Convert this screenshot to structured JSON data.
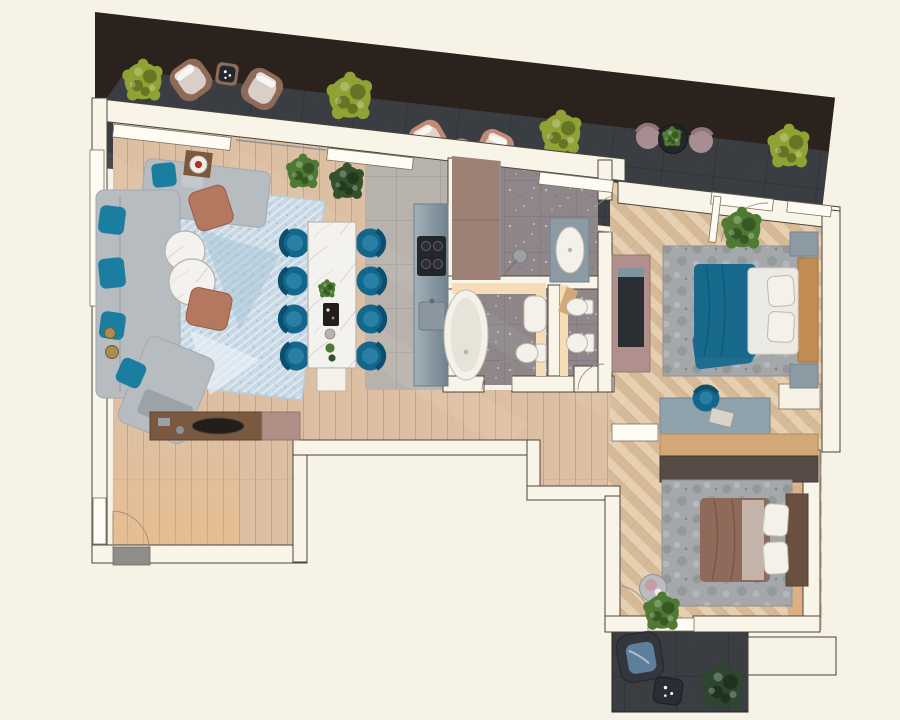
{
  "meta": {
    "label": "Top-down 3D rendered floor plan of a two-bedroom apartment with wrap-around dark-tiled terrace",
    "view": "top-down render",
    "no_visible_text": true
  },
  "palette": {
    "bg": "#f7f2e6",
    "wall_fill": "#f9f4e8",
    "wall_stroke": "#4a443c",
    "sill_fill": "#fdfbf3",
    "sill_stroke": "#79715f",
    "swing_line": "#9a9183",
    "terrace_band": "#2b211d",
    "terrace_tile": "#3a3e43",
    "terrace_grid": "#2e3136",
    "wood_base": "#ddc0a4",
    "wood_grain": "#c7a380",
    "herr_a": "#e7cfb2",
    "herr_b": "#d6b997",
    "kitchen_tile": "#b8b2ac",
    "kitchen_grid": "#a29b94",
    "bath_tile": "#8e8689",
    "bath_grid": "#7b7376",
    "shower_tile": "#9d8175",
    "glow_warm": "#f6ddb6",
    "marble_base": "#f4f2ee",
    "marble_vein": "#cfcac4",
    "sofa_gray": "#b7bcc1",
    "sofa_shadow": "#979da3",
    "pillow_teal": "#1b7da0",
    "pillow_gray": "#c3c8cc",
    "rug_blue": "#c8d9e5",
    "rug_blue_dark": "#8fb3c8",
    "rug_gray": "#a4a8ab",
    "rug_gray_dark": "#84888c",
    "pouf_copper": "#b4785f",
    "chair_teal": "#14678c",
    "chair_teal_dark": "#0c4e6d",
    "chair_teal_light": "#2e85a8",
    "bed1_blanket": "#186a8d",
    "bed2_blanket": "#8d6a5a",
    "linen_white": "#eceae4",
    "linen_stroke": "#cfc9bf",
    "headboard1": "#c28d52",
    "headboard2": "#6b4f41",
    "nightstand": "#8c9aa3",
    "desk_top": "#8fa3ad",
    "shelf_wood": "#d3a878",
    "wardrobe_dark": "#574b45",
    "tv_unit_mauve": "#b08f8c",
    "tv_panel_dark": "#2b2e33",
    "counter_a": "#a3b2ba",
    "counter_b": "#71828e",
    "appliance_dark": "#23262a",
    "steel": "#8a949c",
    "fixture_fill": "#f3f1ea",
    "fixture_stroke": "#bdb8ac",
    "plant_green": "#4e7a33",
    "plant_green_dark": "#33512c",
    "plant_yellow": "#8fa233",
    "plant_balcony": "#2c4630",
    "chair_rose": "#c08a76",
    "chair_brown": "#8d6b58",
    "chair_mauve": "#a88e93",
    "dark_table": "#23262b",
    "cushion_light": "#e6e0da",
    "cushion_blue": "#5e7f9b",
    "console_wood": "#7b5940",
    "console_mauve": "#b09086",
    "tray_dark": "#211e1b",
    "mat_gray": "#8f8d88",
    "accent_red": "#b03028",
    "platform_wood": "#dcb084",
    "candle_brass": "#a98e52"
  },
  "rooms": [
    {
      "id": "terrace",
      "name": "Terrace",
      "floor": "dark tile",
      "furniture": [
        "yellow-green bush x4",
        "brown lounge chair pair with gray cushions",
        "dark side table with candles",
        "rose lounge chair pair",
        "round pink side table",
        "mauve bistro chairs pair",
        "dark bistro table with plant"
      ]
    },
    {
      "id": "living-room",
      "name": "Living room",
      "floor": "light wood plank",
      "furniture": [
        "L-shaped gray sofa",
        "teal velvet pillows",
        "blue patterned rug",
        "two round marble coffee tables",
        "two copper poufs",
        "wood side table with red plate",
        "floor candles",
        "two potted plants",
        "console sideboard with dark tray"
      ]
    },
    {
      "id": "dining-area",
      "name": "Dining area",
      "floor": "light wood plank",
      "furniture": [
        "white marble dining table",
        "eight teal velvet chairs",
        "table plant",
        "dark tray",
        "candles",
        "white end bench"
      ]
    },
    {
      "id": "kitchen",
      "name": "Kitchen",
      "floor": "gray tile",
      "furniture": [
        "steel-blue counter",
        "four-burner cooktop",
        "sink"
      ]
    },
    {
      "id": "shower-room",
      "name": "Shower room",
      "floor": "speckled gray tile",
      "furniture": [
        "walk-in shower",
        "shower head",
        "oval washbasin on counter"
      ]
    },
    {
      "id": "bathroom",
      "name": "Bathroom",
      "floor": "speckled gray tile",
      "furniture": [
        "freestanding oval bathtub",
        "washbasin",
        "toilet",
        "warm lit wall"
      ]
    },
    {
      "id": "wc",
      "name": "WC",
      "floor": "speckled gray tile",
      "furniture": [
        "bidet",
        "toilet",
        "wood shelf"
      ]
    },
    {
      "id": "hallway",
      "name": "Hallway / entry corridor",
      "floor": "light wood plank",
      "furniture": [
        "entry door with mat",
        "door swing"
      ]
    },
    {
      "id": "bedroom-1",
      "name": "Bedroom 1",
      "floor": "herringbone wood",
      "furniture": [
        "double bed with teal blanket",
        "white duvet and pillows",
        "wood headboard",
        "two nightstands",
        "gray mottled rug",
        "potted plant",
        "mauve TV wall unit",
        "desk with teal chair",
        "radio clock"
      ]
    },
    {
      "id": "bedroom-2",
      "name": "Bedroom 2",
      "floor": "herringbone wood",
      "furniture": [
        "double bed with brown blanket",
        "white pillows",
        "dark headboard",
        "gray mottled rug",
        "round side table",
        "potted plant",
        "wood shelf band",
        "dark wardrobe band",
        "sliding door"
      ]
    },
    {
      "id": "balcony",
      "name": "Balcony",
      "floor": "dark tile",
      "furniture": [
        "dark armchair with blue cushion",
        "dark side table with candles",
        "dark green plant"
      ]
    }
  ]
}
